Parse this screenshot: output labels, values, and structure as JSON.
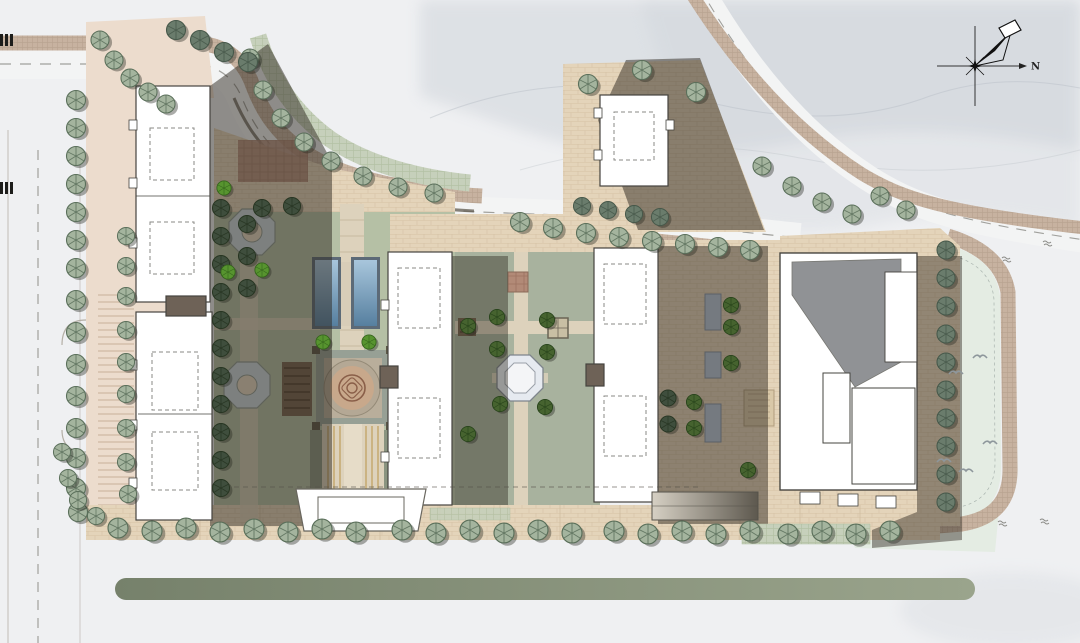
{
  "compass": {
    "label": "N"
  },
  "palette": {
    "css": {
      "paper": "#eff0f2",
      "mist": "#c9cfd6",
      "ridge": "#b9c0c7",
      "band": "#c7b2a0",
      "band-line": "#b09a86",
      "hedge": "#c6d0bb",
      "hedge-line": "#aebd9e",
      "road": "#f3f4f4",
      "dash": "#a0a09c",
      "curb": "#b4afa6",
      "curb-dark": "#5f594f",
      "pink": "#ecdccd",
      "stripe": "#d8c3b0",
      "site-tan": "#e7d8c3",
      "brick": "#e4d4ba",
      "brick-line": "#cdb99c",
      "lawn": "#b5c0a5",
      "lawn-right": "#e4ece3",
      "court": "#a8b29e",
      "walk": "#ddd2bc",
      "walk-line": "#bfb198",
      "wood": "#c6a96f",
      "brown-core": "#6e6257",
      "shadow": "#2e281f",
      "bld": "#ffffff",
      "bld-line": "#45443f",
      "roof-gray": "#909295",
      "pool-frame": "#5c6a77",
      "water-a": "#a8c6dc",
      "water-b": "#567f9f",
      "canopy": "#b7c6d8",
      "canopy-line": "#8295a8",
      "median-a": "#76816b",
      "median-b": "#9aa48c",
      "oct": "#ccd8de",
      "ring": "#b4a895",
      "medallion": "#c8a88b",
      "medallion-line": "#8a5f49",
      "pav": "#e6eaf0",
      "red-a": "#b28a77",
      "red-b": "#9c7260",
      "ramp-a": "#d6d0c4",
      "ramp-b": "#5d584e",
      "gate-line": "#6a675f",
      "bird": "#8e979c",
      "annot": "#8a8a86",
      "hatch": "#1d1d1b"
    },
    "tree_variants": {
      "street": {
        "body": "#a4b49e",
        "line": "#5a6f5a"
      },
      "dark": {
        "body": "#6a7c6c",
        "line": "#46584a"
      },
      "shade": {
        "body": "#3f4e3d",
        "line": "#273522"
      },
      "court": {
        "body": "#46632f",
        "line": "#27431a"
      },
      "bright": {
        "body": "#57942f",
        "line": "#33611b"
      }
    }
  },
  "scene": {
    "description": "Rendered residential-community landscape master plan, top-down site plan with perimeter roads, street-tree rows, slab apartment buildings casting shadows, axial garden with twin reflecting pools, circular longevity-motif paving medallion, octagonal pavilion courtyard, retail block, lawn with birds, misty mountain wash and north compass.",
    "trees": [
      {
        "variant": "street",
        "s": 1,
        "pts": [
          [
            76,
            100
          ],
          [
            76,
            128
          ],
          [
            76,
            156
          ],
          [
            76,
            184
          ],
          [
            76,
            212
          ],
          [
            76,
            240
          ],
          [
            76,
            268
          ],
          [
            76,
            300
          ],
          [
            76,
            332
          ],
          [
            76,
            364
          ],
          [
            76,
            396
          ],
          [
            76,
            428
          ],
          [
            76,
            458
          ],
          [
            76,
            488
          ],
          [
            78,
            512
          ]
        ]
      },
      {
        "variant": "street",
        "s": 0.9,
        "pts": [
          [
            126,
            236
          ],
          [
            126,
            266
          ],
          [
            126,
            296
          ],
          [
            126,
            330
          ],
          [
            126,
            362
          ],
          [
            126,
            394
          ],
          [
            126,
            428
          ],
          [
            126,
            462
          ],
          [
            128,
            494
          ]
        ]
      },
      {
        "variant": "street",
        "s": 0.95,
        "pts": [
          [
            100,
            40
          ],
          [
            114,
            60
          ],
          [
            130,
            78
          ],
          [
            148,
            92
          ],
          [
            166,
            104
          ]
        ]
      },
      {
        "variant": "street",
        "s": 0.95,
        "pts": [
          [
            250,
            58
          ],
          [
            263,
            90
          ],
          [
            281,
            118
          ],
          [
            304,
            142
          ],
          [
            331,
            161
          ],
          [
            363,
            176
          ],
          [
            398,
            187
          ],
          [
            434,
            193
          ]
        ]
      },
      {
        "variant": "street",
        "s": 1,
        "pts": [
          [
            520,
            222
          ],
          [
            553,
            228
          ],
          [
            586,
            233
          ],
          [
            619,
            237
          ],
          [
            652,
            241
          ],
          [
            685,
            244
          ],
          [
            718,
            247
          ],
          [
            750,
            250
          ]
        ]
      },
      {
        "variant": "street",
        "s": 0.95,
        "pts": [
          [
            762,
            166
          ],
          [
            792,
            186
          ],
          [
            822,
            202
          ],
          [
            852,
            214
          ],
          [
            880,
            196
          ],
          [
            906,
            210
          ]
        ]
      },
      {
        "variant": "street",
        "s": 1,
        "pts": [
          [
            588,
            84
          ],
          [
            642,
            70
          ],
          [
            696,
            92
          ]
        ]
      },
      {
        "variant": "street",
        "s": 1.05,
        "pts": [
          [
            118,
            528
          ],
          [
            152,
            531
          ],
          [
            186,
            528
          ],
          [
            220,
            532
          ],
          [
            254,
            529
          ],
          [
            288,
            532
          ],
          [
            322,
            529
          ],
          [
            356,
            532
          ],
          [
            402,
            530
          ],
          [
            436,
            533
          ],
          [
            470,
            530
          ],
          [
            504,
            533
          ],
          [
            538,
            530
          ],
          [
            572,
            533
          ],
          [
            614,
            531
          ],
          [
            648,
            534
          ],
          [
            682,
            531
          ],
          [
            716,
            534
          ],
          [
            750,
            531
          ],
          [
            788,
            534
          ],
          [
            822,
            531
          ],
          [
            856,
            534
          ],
          [
            890,
            531
          ]
        ]
      },
      {
        "variant": "street",
        "s": 0.9,
        "pts": [
          [
            62,
            452
          ],
          [
            68,
            478
          ],
          [
            78,
            500
          ],
          [
            96,
            516
          ]
        ]
      },
      {
        "variant": "dark",
        "s": 1,
        "pts": [
          [
            176,
            30
          ],
          [
            200,
            40
          ],
          [
            224,
            52
          ],
          [
            248,
            62
          ]
        ]
      },
      {
        "variant": "dark",
        "s": 0.9,
        "pts": [
          [
            582,
            206
          ],
          [
            608,
            210
          ],
          [
            634,
            214
          ],
          [
            660,
            217
          ]
        ]
      },
      {
        "variant": "dark",
        "s": 0.95,
        "pts": [
          [
            946,
            250
          ],
          [
            946,
            278
          ],
          [
            946,
            306
          ],
          [
            946,
            334
          ],
          [
            946,
            362
          ],
          [
            946,
            390
          ],
          [
            946,
            418
          ],
          [
            946,
            446
          ],
          [
            946,
            474
          ],
          [
            946,
            502
          ]
        ]
      },
      {
        "variant": "shade",
        "s": 0.9,
        "pts": [
          [
            221,
            208
          ],
          [
            221,
            236
          ],
          [
            221,
            264
          ],
          [
            221,
            292
          ],
          [
            221,
            320
          ],
          [
            221,
            348
          ],
          [
            221,
            376
          ],
          [
            221,
            404
          ],
          [
            221,
            432
          ],
          [
            221,
            460
          ],
          [
            221,
            488
          ],
          [
            247,
            224
          ],
          [
            247,
            256
          ],
          [
            247,
            288
          ],
          [
            262,
            208
          ],
          [
            292,
            206
          ]
        ]
      },
      {
        "variant": "shade",
        "s": 0.85,
        "pts": [
          [
            668,
            398
          ],
          [
            668,
            424
          ]
        ]
      },
      {
        "variant": "court",
        "s": 0.8,
        "pts": [
          [
            497,
            317
          ],
          [
            547,
            320
          ],
          [
            497,
            349
          ],
          [
            547,
            352
          ],
          [
            500,
            404
          ],
          [
            545,
            407
          ],
          [
            468,
            326
          ],
          [
            468,
            434
          ],
          [
            731,
            305
          ],
          [
            731,
            327
          ],
          [
            731,
            363
          ],
          [
            694,
            402
          ],
          [
            694,
            428
          ],
          [
            748,
            470
          ]
        ]
      },
      {
        "variant": "bright",
        "s": 0.75,
        "pts": [
          [
            323,
            342
          ],
          [
            369,
            342
          ],
          [
            224,
            188
          ],
          [
            228,
            272
          ],
          [
            262,
            270
          ]
        ]
      }
    ],
    "pools": [
      {
        "x": 315,
        "y": 260,
        "w": 23,
        "h": 66
      },
      {
        "x": 354,
        "y": 260,
        "w": 23,
        "h": 66
      }
    ],
    "canopies": [
      {
        "x": 705,
        "y": 294,
        "w": 16,
        "h": 36
      },
      {
        "x": 705,
        "y": 352,
        "w": 16,
        "h": 26
      },
      {
        "x": 705,
        "y": 404,
        "w": 16,
        "h": 38
      }
    ],
    "birds": [
      [
        956,
        372
      ],
      [
        980,
        356
      ],
      [
        944,
        460
      ],
      [
        966,
        470
      ],
      [
        990,
        442
      ]
    ],
    "annotations": [
      [
        1002,
        258
      ],
      [
        998,
        522
      ],
      [
        1043,
        242
      ],
      [
        1040,
        520
      ]
    ]
  }
}
